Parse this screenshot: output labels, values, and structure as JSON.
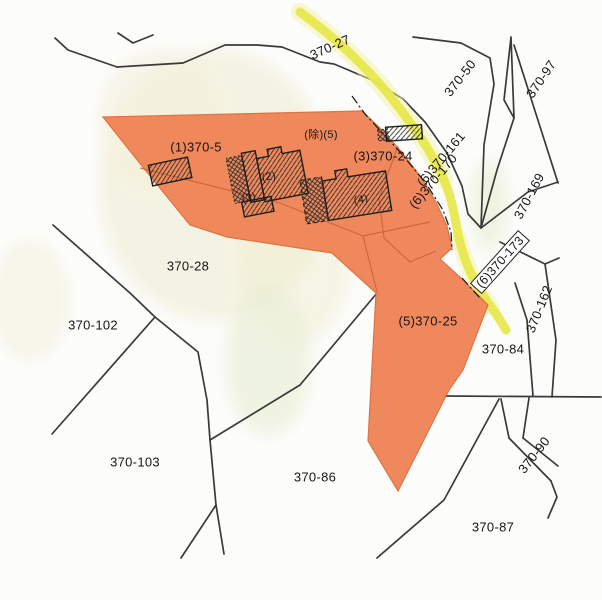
{
  "map": {
    "colors": {
      "selection_fill": "#EF8355",
      "selection_border": "#DD6B3A",
      "road_highlight": "#E7E84B",
      "boundary_line": "#3A3A3A",
      "background": "#FCFCFA"
    },
    "labels": [
      {
        "text": "370-27",
        "x": 330,
        "y": 47,
        "r": -24,
        "kind": "parcel"
      },
      {
        "text": "370-50",
        "x": 460,
        "y": 78,
        "r": -52,
        "kind": "parcel"
      },
      {
        "text": "370-97",
        "x": 541,
        "y": 79,
        "r": -56,
        "kind": "parcel"
      },
      {
        "text": "(1)370-5",
        "x": 196,
        "y": 147,
        "r": 0,
        "kind": "parcel"
      },
      {
        "text": "(3)370-24",
        "x": 383,
        "y": 156,
        "r": 0,
        "kind": "parcel"
      },
      {
        "text": "(6)370-161",
        "x": 441,
        "y": 159,
        "r": -50,
        "kind": "parcel"
      },
      {
        "text": "(6)370-170",
        "x": 433,
        "y": 181,
        "r": -50,
        "kind": "parcel"
      },
      {
        "text": "370-169",
        "x": 529,
        "y": 196,
        "r": -62,
        "kind": "parcel"
      },
      {
        "text": "370-28",
        "x": 188,
        "y": 266,
        "r": 0,
        "kind": "parcel"
      },
      {
        "text": "(6)370-173",
        "x": 500,
        "y": 262,
        "r": -48,
        "kind": "parcel",
        "boxed": true
      },
      {
        "text": "370-162",
        "x": 539,
        "y": 309,
        "r": -68,
        "kind": "parcel"
      },
      {
        "text": "(5)370-25",
        "x": 428,
        "y": 321,
        "r": 0,
        "kind": "parcel"
      },
      {
        "text": "370-102",
        "x": 93,
        "y": 325,
        "r": 0,
        "kind": "parcel"
      },
      {
        "text": "370-84",
        "x": 503,
        "y": 349,
        "r": 0,
        "kind": "parcel"
      },
      {
        "text": "370-90",
        "x": 534,
        "y": 455,
        "r": -52,
        "kind": "parcel"
      },
      {
        "text": "370-103",
        "x": 135,
        "y": 462,
        "r": 0,
        "kind": "parcel"
      },
      {
        "text": "370-86",
        "x": 315,
        "y": 477,
        "r": 0,
        "kind": "parcel"
      },
      {
        "text": "370-87",
        "x": 493,
        "y": 527,
        "r": 0,
        "kind": "parcel"
      },
      {
        "text": "(除)(5)",
        "x": 321,
        "y": 134,
        "r": 0,
        "kind": "building"
      },
      {
        "text": "(2)",
        "x": 269,
        "y": 177,
        "r": -10,
        "kind": "building"
      },
      {
        "text": "(3)",
        "x": 249,
        "y": 198,
        "r": -10,
        "kind": "building"
      },
      {
        "text": "(4)",
        "x": 361,
        "y": 200,
        "r": -8,
        "kind": "building"
      }
    ]
  }
}
